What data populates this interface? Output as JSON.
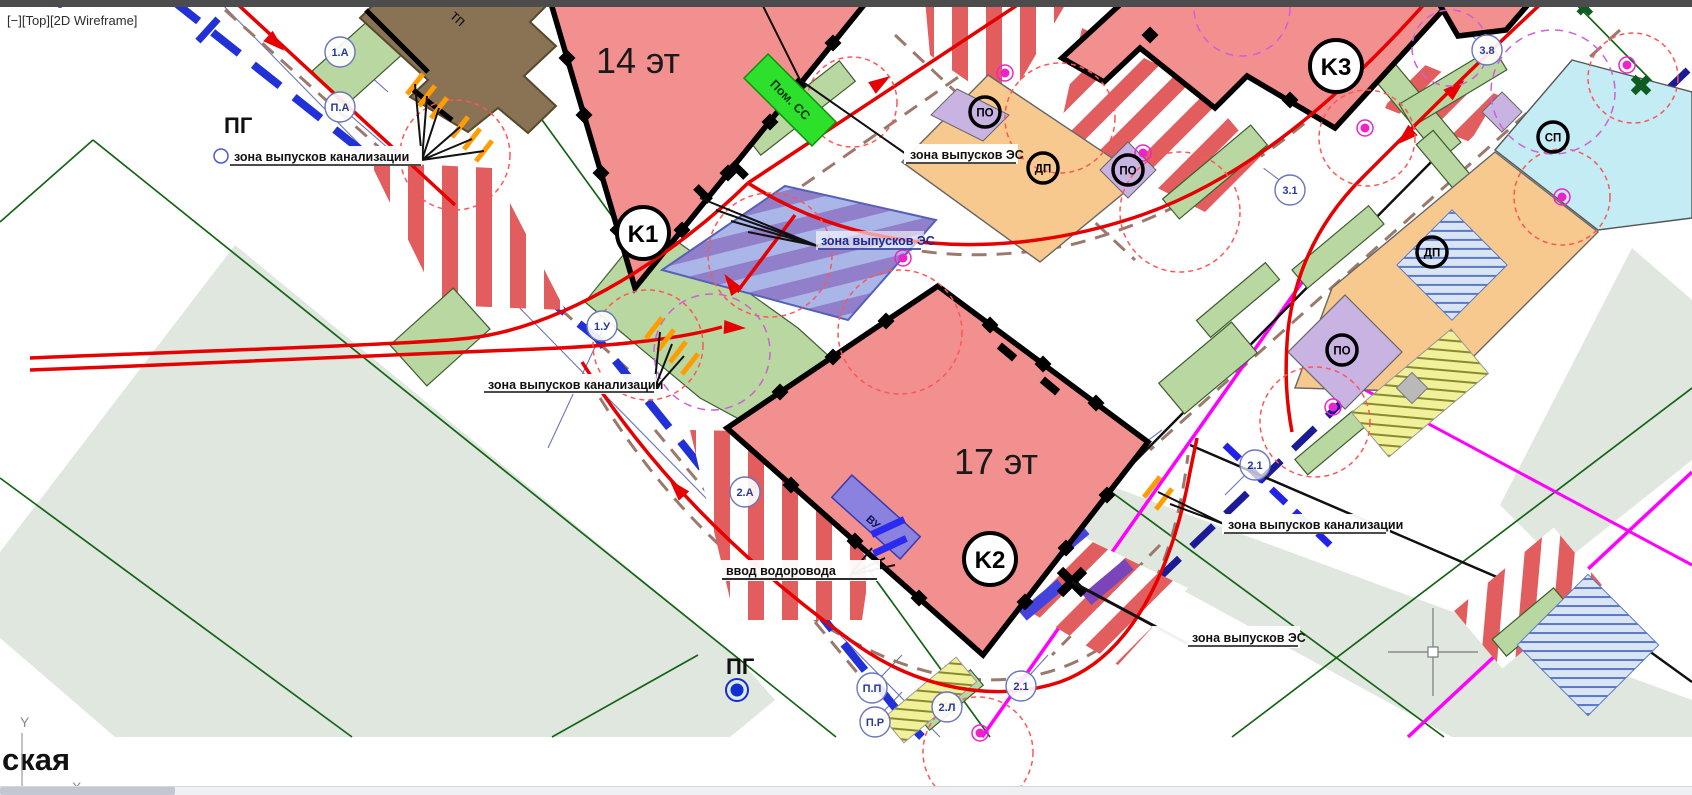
{
  "viewport": {
    "minimize_label": "[−]",
    "view_label": "[Top]",
    "visual_style_label": "[2D Wireframe]"
  },
  "map": {
    "buildings": [
      {
        "mark": "K1",
        "floors": "14 эт"
      },
      {
        "mark": "K2",
        "floors": "17 эт"
      },
      {
        "mark": "K3"
      }
    ],
    "annotations": {
      "sewer_outlet_zone": "зона выпусков канализации",
      "electric_outlet_zone": "зона выпусков ЭС",
      "water_inlet": "ввод водоровода",
      "room_ss": "Пом. СС",
      "fire_hydrant": "ПГ",
      "transformer": "тп",
      "water_unit": "ВУ",
      "street_name_fragment": "ская"
    },
    "nodes": [
      "1.А",
      "П.А",
      "1.У",
      "2.А",
      "П.П",
      "2.Л",
      "2.1",
      "П.Р",
      "2.1",
      "3.1",
      "3.8"
    ],
    "facility_marks": [
      "ПО",
      "ДП",
      "ПО",
      "ПО",
      "ДП",
      "СП"
    ],
    "colors": {
      "building_fill": "#f2908f",
      "zone_stripe_red": "#e25d5d",
      "landscaping_green": "#b9d7a0",
      "service_orange": "#f8c98e",
      "service_cyan": "#c4ecf4",
      "service_purple": "#c9b3e3",
      "transformer_brown": "#8a7354",
      "water_main_blue": "#2230d8",
      "utility_navy": "#1b1b96",
      "boundary_magenta": "#ff00ff",
      "route_red": "#e60000",
      "access_dash_brown": "#9b7a6d",
      "hydrant_blue": "#0f2fd0",
      "room_ss_green": "#2ce02c"
    }
  }
}
